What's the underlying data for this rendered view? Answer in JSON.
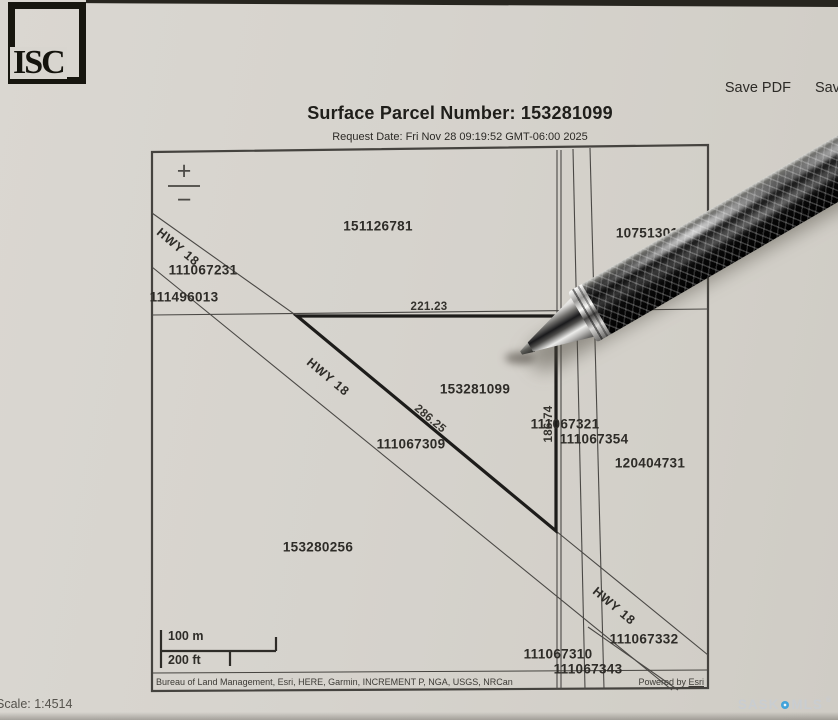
{
  "logo": {
    "text": "ISC"
  },
  "toolbar": {
    "save_pdf_label": "Save PDF",
    "save_label": "Save"
  },
  "title": "Surface Parcel Number: 153281099",
  "request_date": "Request Date: Fri Nov 28 09:19:52 GMT-06:00 2025",
  "map": {
    "zoom_in_label": "+",
    "zoom_out_label": "−",
    "labels": [
      {
        "text": "151126781",
        "x": 378,
        "y": 226,
        "rot": 0,
        "kind": "parcel"
      },
      {
        "text": "107513018",
        "x": 651,
        "y": 233,
        "rot": 0,
        "kind": "parcel"
      },
      {
        "text": "HWY 18",
        "x": 178,
        "y": 247,
        "rot": 40,
        "kind": "hwy"
      },
      {
        "text": "111067231",
        "x": 203,
        "y": 270,
        "rot": 0,
        "kind": "parcel"
      },
      {
        "text": "111496013",
        "x": 184,
        "y": 297,
        "rot": 0,
        "kind": "parcel"
      },
      {
        "text": "221.23",
        "x": 429,
        "y": 307,
        "rot": 0,
        "kind": "dim"
      },
      {
        "text": "HWY 18",
        "x": 328,
        "y": 377,
        "rot": 40,
        "kind": "hwy"
      },
      {
        "text": "153281099",
        "x": 475,
        "y": 389,
        "rot": 0,
        "kind": "parcel"
      },
      {
        "text": "286.25",
        "x": 430,
        "y": 419,
        "rot": 40,
        "kind": "dim"
      },
      {
        "text": "186.74",
        "x": 549,
        "y": 424,
        "rot": -90,
        "kind": "dim"
      },
      {
        "text": "111067321",
        "x": 565,
        "y": 424,
        "rot": 0,
        "kind": "parcel"
      },
      {
        "text": "111067354",
        "x": 594,
        "y": 439,
        "rot": 0,
        "kind": "parcel"
      },
      {
        "text": "111067309",
        "x": 411,
        "y": 444,
        "rot": 0,
        "kind": "parcel"
      },
      {
        "text": "120404731",
        "x": 650,
        "y": 463,
        "rot": 0,
        "kind": "parcel"
      },
      {
        "text": "153280256",
        "x": 318,
        "y": 547,
        "rot": 0,
        "kind": "parcel"
      },
      {
        "text": "HWY 18",
        "x": 614,
        "y": 606,
        "rot": 40,
        "kind": "hwy"
      },
      {
        "text": "111067332",
        "x": 644,
        "y": 639,
        "rot": 0,
        "kind": "parcel"
      },
      {
        "text": "111067310",
        "x": 558,
        "y": 654,
        "rot": 0,
        "kind": "parcel"
      },
      {
        "text": "111067343",
        "x": 588,
        "y": 669,
        "rot": 0,
        "kind": "parcel"
      }
    ],
    "scale_bar": {
      "metric_label": "100 m",
      "imperial_label": "200 ft"
    },
    "attribution": "Bureau of Land Management, Esri, HERE, Garmin, INCREMENT P, NGA, USGS, NRCan",
    "powered_by_prefix": "Powered by ",
    "powered_by_brand": "Esri"
  },
  "footer": {
    "scale_text": "Scale: 1:4514",
    "watermark_sask": "SASK",
    "watermark_mls": "MLS",
    "watermark_reg": "®"
  },
  "colors": {
    "paper": "#d6d3cd",
    "thin_line": "#4a4845",
    "bold_line": "#1d1c1a",
    "watermark_dot": "#41a3da"
  }
}
